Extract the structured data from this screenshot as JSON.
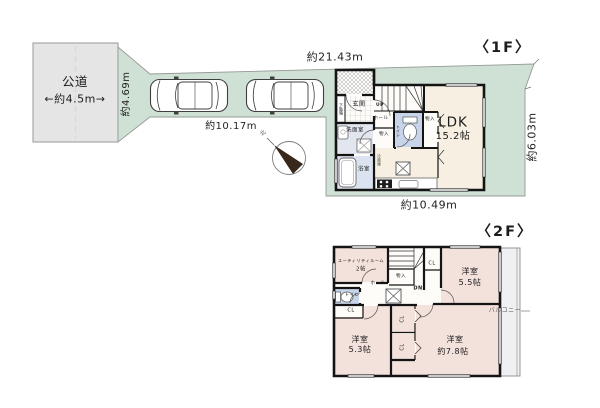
{
  "site": {
    "road_name": "公道",
    "road_width": "←約4.5m→",
    "dim_frontage": "約4.69m",
    "dim_top": "約21.43m",
    "dim_driveway": "約10.17m",
    "dim_bottom": "約10.49m",
    "dim_right": "約6.03m",
    "compass_north": "北"
  },
  "floor1": {
    "title": "〈1F〉",
    "ldk_name": "LDK",
    "ldk_size": "15.2帖",
    "entrance": "玄関",
    "shoe_cabinet": "下駄箱",
    "hall": "ホール",
    "stairs": "UP",
    "toilet": "トイレ",
    "storage_hall": "物入",
    "storage_ldk": "物入",
    "washroom": "洗面室",
    "bathroom": "浴室",
    "fridge": "冷蔵庫"
  },
  "floor2": {
    "title": "〈2F〉",
    "utility_name": "ユーティリティルーム",
    "utility_size": "2帖",
    "stairs": "DN",
    "storage": "物入",
    "hall": "ホール",
    "toilet": "トイレ",
    "closet_a": "CL",
    "closet_b": "CL",
    "closet_c": "CL",
    "closet_d": "CL",
    "bedroom_a_name": "洋室",
    "bedroom_a_size": "5.5帖",
    "bedroom_b_name": "洋室",
    "bedroom_b_size": "5.3帖",
    "bedroom_c_name": "洋室",
    "bedroom_c_size": "約7.8帖",
    "balcony": "バルコニー"
  }
}
